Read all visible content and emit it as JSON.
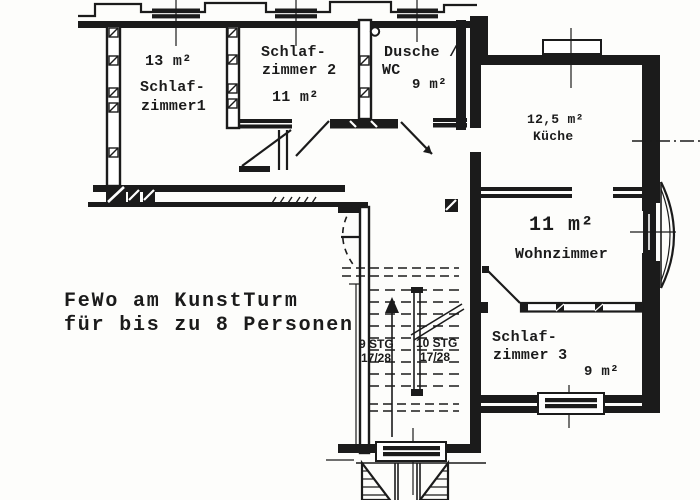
{
  "colors": {
    "ink": "#1b1b1b",
    "paper": "#fdfdfb"
  },
  "title": {
    "line1": "FeWo am KunstTurm",
    "line2": "für bis zu 8 Personen"
  },
  "rooms": {
    "schlafzimmer1": {
      "area": "13 m²",
      "name_line1": "Schlaf-",
      "name_line2": "zimmer1"
    },
    "schlafzimmer2": {
      "name_line1": "Schlaf-",
      "name_line2": "zimmer 2",
      "area": "11 m²"
    },
    "dusche_wc": {
      "name_line1": "Dusche /",
      "name_line2": "WC",
      "area": "9 m²"
    },
    "kueche": {
      "area": "12,5 m²",
      "name": "Küche"
    },
    "wohnzimmer": {
      "area": "11 m²",
      "name": "Wohnzimmer"
    },
    "schlafzimmer3": {
      "name_line1": "Schlaf-",
      "name_line2": "zimmer 3",
      "area": "9 m²"
    }
  },
  "stairs": {
    "flight_left": {
      "steps": "9 STG",
      "rise_run": "17/28"
    },
    "flight_right": {
      "steps": "10 STG",
      "rise_run": "17/28"
    }
  }
}
